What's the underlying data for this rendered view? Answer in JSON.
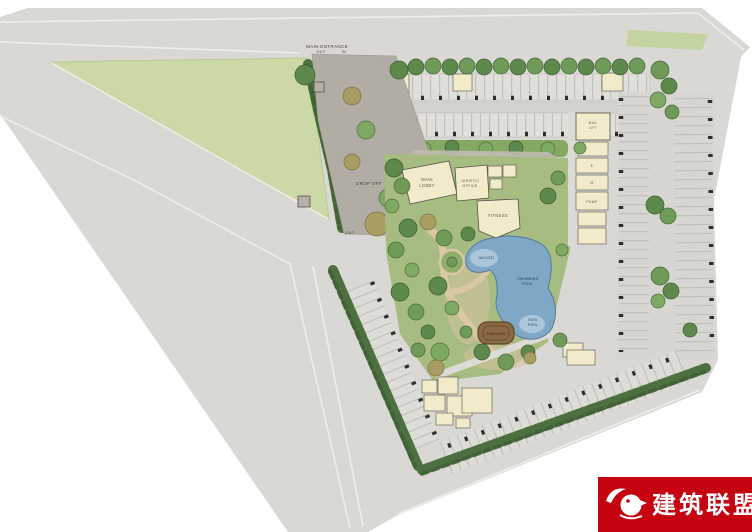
{
  "watermark": {
    "name": "建筑联盟",
    "bg_color": "#c60310",
    "logo": "bird-logo"
  },
  "labels": {
    "main_entrance": "MAIN ENTRANCE",
    "gate_out": "OUT",
    "gate_in": "IN",
    "drop_off": "DROP OFF",
    "side_out": "OUT",
    "main_lobby_1": "MAIN",
    "main_lobby_2": "LOBBY",
    "juristic_1": "JURISTIC",
    "juristic_2": "OFFICE",
    "fitness": "FITNESS",
    "mail_1": "MAIL",
    "mail_2": "LIFT",
    "room_e": "E",
    "room_m": "M",
    "pump": "PUMP",
    "jacuzzi": "JACUZZI",
    "swimming_1": "SWIMMING",
    "swimming_2": "POOL",
    "kids_1": "KIDS",
    "kids_2": "POOL",
    "pavilion": "PAVILION"
  },
  "colors": {
    "page": "#ffffff",
    "road": "#d9d8d5",
    "grass_field": "#ccd9a7",
    "verge": "#c3d4a0",
    "lawn": "#a6bc81",
    "parking_row": "#e0dfda",
    "aisle": "#d2d1cc",
    "drive": "#b2ada4",
    "plaza": "#c0bbb2",
    "cream_building": "#f2ebc9",
    "pool": "#7fa8c6",
    "pool_light": "#a9c6da",
    "hedge": "#4d7040",
    "tree_green": "#6f9a57",
    "tree_olive": "#a89d63",
    "pavilion_brown": "#8a6a42",
    "deck_tan": "#d2c29c",
    "column_tick": "#2e2e2c",
    "watermark_red": "#c60310"
  }
}
